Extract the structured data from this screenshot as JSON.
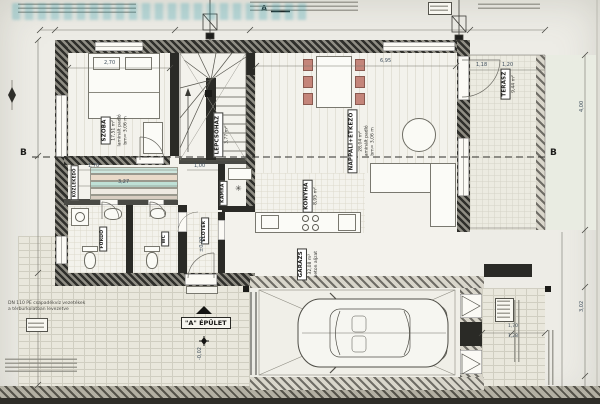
{
  "plan": {
    "type": "ground-floor architectural plan (scan)",
    "building_label": "\"A\" ÉPÜLET",
    "section_a": "A",
    "section_b_left": "B",
    "section_b_right": "B"
  },
  "rooms": [
    {
      "name": "SZOBA",
      "area": "17,51 m²",
      "floor": "laminált padló",
      "height": "bm= 3,06 m"
    },
    {
      "name": "LÉPCSŐHÁZ",
      "area": "3,77 m²"
    },
    {
      "name": "NAPPALI+ÉTKEZŐ",
      "area": "28,04 m²",
      "floor": "laminált padló",
      "height": "bm= 3,06 m"
    },
    {
      "name": "KONYHA",
      "area": "8,95 m²"
    },
    {
      "name": "KAMRA"
    },
    {
      "name": "ELŐTÉR"
    },
    {
      "name": "FÜRDŐ"
    },
    {
      "name": "WC"
    },
    {
      "name": "KÖZLEKEDŐ"
    },
    {
      "name": "TERASZ",
      "area": "9,44 m²"
    },
    {
      "name": "GARÁZS",
      "area": "32,08 m²",
      "floor": "beton aljzat"
    }
  ],
  "dims": [
    "2,70",
    "6,95",
    "1,18",
    "1,20",
    "1,70",
    "3,27",
    "1,00",
    "4,00",
    "3,02",
    "1,70",
    "1,28",
    "±0,00",
    "-0,02"
  ],
  "annotations": {
    "drain_l1": "DN 110 PE csapadékvíz vezetékek",
    "drain_l2": "a térburkolatban levezetve"
  },
  "colors": {
    "wall_dark": "#2a2a26",
    "paper": "#edece6",
    "paving_line": "#d0cec1",
    "accent_teal": "#cde6dd",
    "accent_tan": "#e9dac9",
    "chair_red": "#c4857a",
    "dim_text": "#3f4e5c",
    "watermark_teal": "#2a9cac"
  }
}
